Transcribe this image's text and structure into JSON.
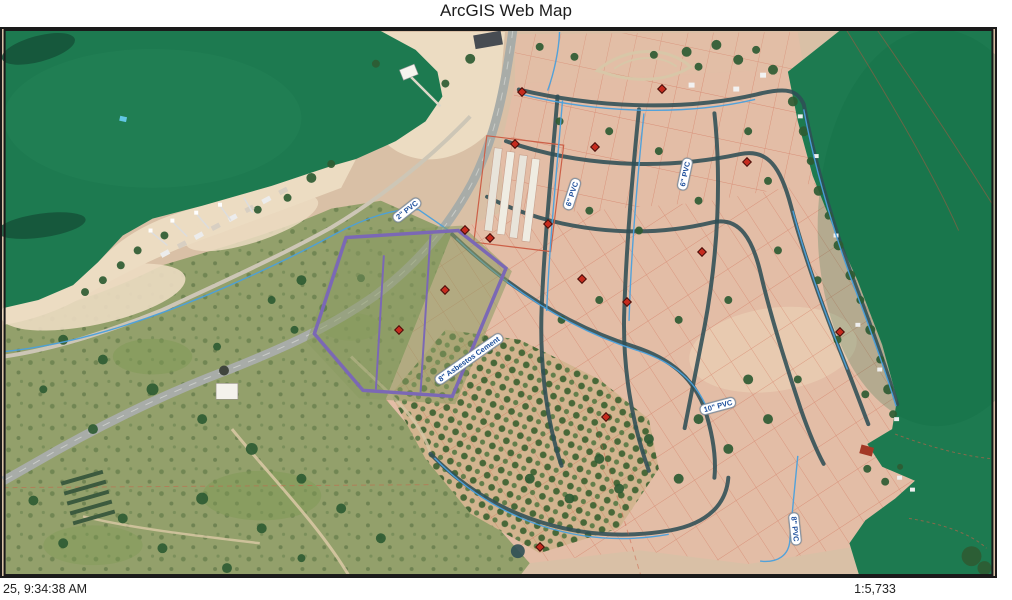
{
  "title": "ArcGIS Web Map",
  "footer": {
    "timestamp": "25, 9:34:38 AM",
    "scale": "1:5,733"
  },
  "map": {
    "colors": {
      "water": "#1d7a50",
      "land": "#d9c0a6",
      "sand": "#ecdcc2",
      "scrub": "#93a06b",
      "field": "#8a9a62",
      "subdivision": "#e3bda6",
      "road": "#a8aca8",
      "street": "#2f4f55",
      "pipe": "#4aa0dc",
      "parcel_line": "#cc5f47",
      "parcel_selected": "#7b68b5",
      "hydrant": "#c62b1e",
      "tree": "#2e5b33",
      "label_text": "#1d4f9c",
      "label_bg": "#ffffff"
    },
    "pipe_labels": [
      {
        "text": "2\" PVC",
        "x": 405,
        "y": 181,
        "rot": -38
      },
      {
        "text": "6\" PVC",
        "x": 570,
        "y": 165,
        "rot": -72
      },
      {
        "text": "6\" PVC",
        "x": 683,
        "y": 145,
        "rot": -78
      },
      {
        "text": "8\" Asbestos Cement",
        "x": 467,
        "y": 330,
        "rot": -35
      },
      {
        "text": "10\" PVC",
        "x": 716,
        "y": 377,
        "rot": -15
      },
      {
        "text": "8\" PVC",
        "x": 793,
        "y": 500,
        "rot": 84
      }
    ],
    "hydrants": [
      [
        520,
        63
      ],
      [
        513,
        115
      ],
      [
        593,
        118
      ],
      [
        463,
        201
      ],
      [
        488,
        209
      ],
      [
        443,
        261
      ],
      [
        397,
        301
      ],
      [
        546,
        195
      ],
      [
        625,
        273
      ],
      [
        700,
        223
      ],
      [
        745,
        133
      ],
      [
        838,
        303
      ],
      [
        604,
        388
      ],
      [
        538,
        518
      ],
      [
        660,
        60
      ],
      [
        580,
        250
      ]
    ]
  }
}
